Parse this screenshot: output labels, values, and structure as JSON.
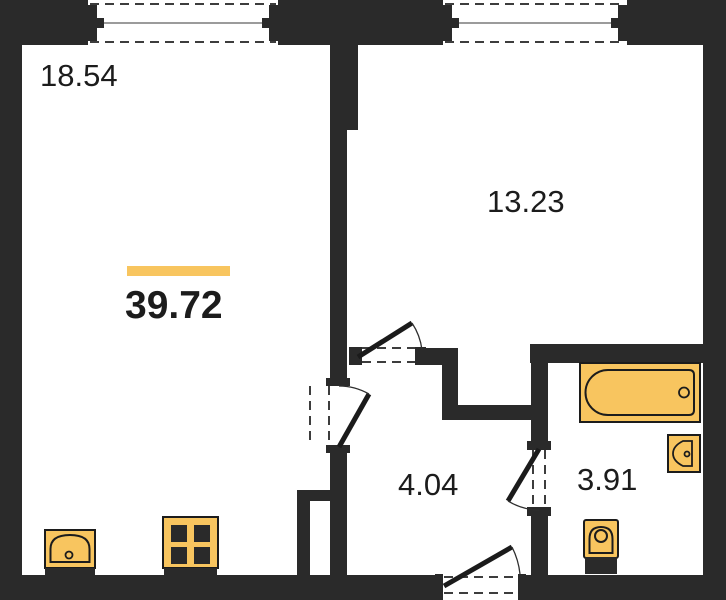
{
  "plan": {
    "total_area": "39.72",
    "rooms": [
      {
        "id": "living-room",
        "area": "18.54"
      },
      {
        "id": "bedroom",
        "area": "13.23"
      },
      {
        "id": "hallway",
        "area": "4.04"
      },
      {
        "id": "bathroom",
        "area": "3.91"
      }
    ],
    "fixtures": [
      "kitchen-sink",
      "stove",
      "bathtub",
      "washbasin",
      "toilet"
    ],
    "windows_count": 2,
    "doors": {
      "interior_count": 3,
      "entrance_count": 1
    },
    "colors": {
      "wall": "#2a2a2a",
      "accent": "#F8C55F",
      "fixture_fill": "#F8C55F",
      "fixture_stroke": "#1c1c1c",
      "background": "#ffffff",
      "text": "#1c1c1c"
    }
  }
}
